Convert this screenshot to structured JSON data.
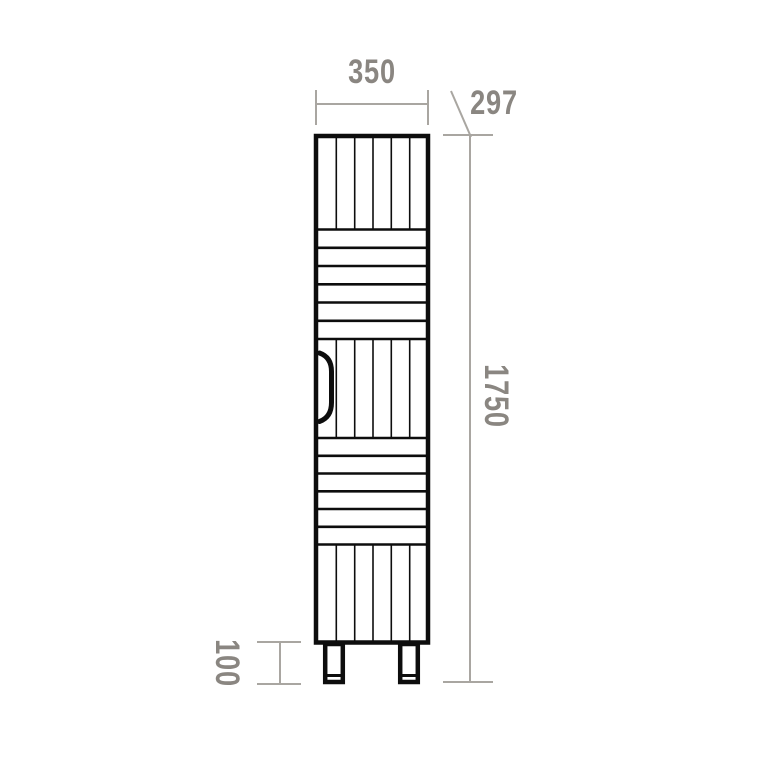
{
  "diagram": {
    "kind": "cabinet front-elevation dimension drawing",
    "dimensions": {
      "width": "350",
      "depth": "297",
      "height": "1750",
      "leg_height": "100"
    },
    "structure": {
      "slat_columns": 6,
      "upper_horizontal_bands": 6,
      "lower_horizontal_bands": 6,
      "legs": 2
    }
  },
  "colors": {
    "background": "#ffffff",
    "outline": "#0d0d0d",
    "dimension_line": "#a9a6a1",
    "dimension_text": "#8a8681"
  }
}
